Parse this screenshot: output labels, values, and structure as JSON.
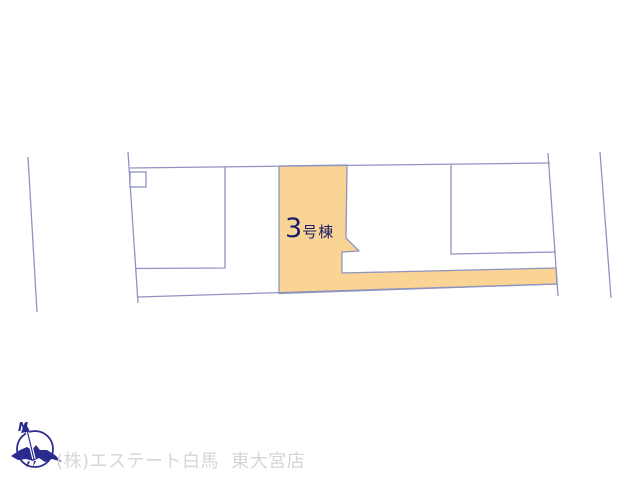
{
  "canvas": {
    "width": 640,
    "height": 480,
    "background": "#ffffff"
  },
  "colors": {
    "lot_highlight_fill": "#F9D494",
    "plan_line": "#8F93C0",
    "label_navy": "#1C1C6E",
    "logo_navy": "#2B2B8F",
    "watermark_gray": "#D6D6D6"
  },
  "plan": {
    "building_label": {
      "number": "3",
      "suffix": "号棟"
    }
  },
  "footer": {
    "compass_n": "N",
    "company": "(株)エステート白馬 東大宮店"
  }
}
